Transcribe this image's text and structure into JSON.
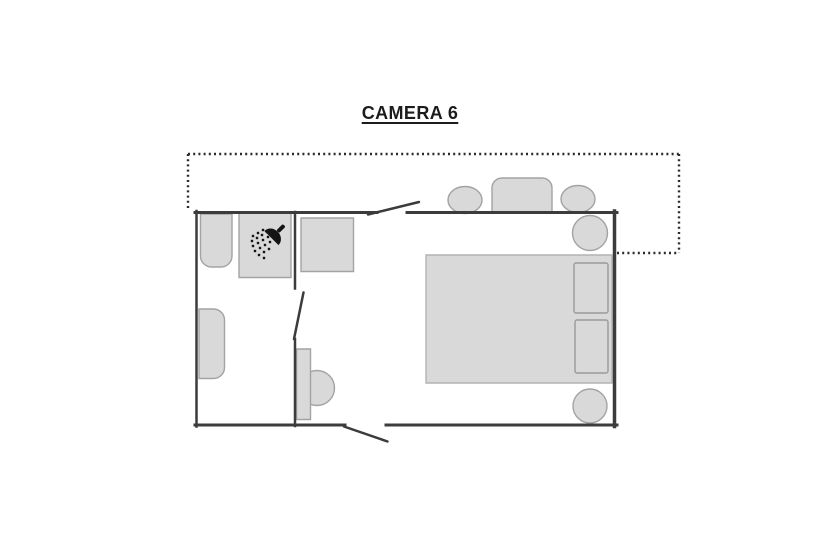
{
  "title": {
    "text": "CAMERA 6"
  },
  "canvas": {
    "width": 820,
    "height": 560
  },
  "colors": {
    "background": "#ffffff",
    "wall": "#3c3c3c",
    "door": "#3c3c3c",
    "dotted": "#2b2b2b",
    "furniture_fill": "#d9d9d9",
    "furniture_stroke": "#a3a3a3",
    "pillow_stroke": "#9a9a9a",
    "bed_stroke": "#b3b3b3",
    "icon": "#141414",
    "title_color": "#1c1c1c"
  },
  "plan": {
    "terrace_outline": {
      "name": "terrace-dotted-outline",
      "dash": "2 3.2",
      "width": 2.4,
      "segments": [
        [
          188,
          154,
          680,
          154
        ],
        [
          188,
          154,
          188,
          209
        ],
        [
          679,
          154,
          679,
          253
        ],
        [
          617,
          253,
          679,
          253
        ]
      ]
    },
    "furniture": [
      {
        "name": "terrace-chair-left",
        "type": "ellipse",
        "cx": 465,
        "cy": 200,
        "rx": 17,
        "ry": 13.5
      },
      {
        "name": "terrace-table",
        "type": "rect",
        "x": 492,
        "y": 178,
        "w": 60,
        "h": 34.5,
        "radii": [
          10,
          10,
          2,
          2
        ]
      },
      {
        "name": "terrace-chair-right",
        "type": "ellipse",
        "cx": 578,
        "cy": 199,
        "rx": 17,
        "ry": 13.5
      },
      {
        "name": "washbasin",
        "type": "rect",
        "x": 200.5,
        "y": 214,
        "w": 31.5,
        "h": 53,
        "radii": [
          0,
          0,
          11,
          11
        ]
      },
      {
        "name": "shower-tray",
        "type": "rect",
        "x": 239,
        "y": 213,
        "w": 52,
        "h": 64.5,
        "radii": [
          0,
          0,
          0,
          0
        ]
      },
      {
        "name": "toilet",
        "type": "rect",
        "x": 199,
        "y": 309,
        "w": 25.5,
        "h": 69.5,
        "radii": [
          0,
          11,
          11,
          0
        ]
      },
      {
        "name": "media-cabinet",
        "type": "rect",
        "x": 301,
        "y": 218,
        "w": 52.5,
        "h": 53.5,
        "radii": [
          0,
          0,
          0,
          0
        ]
      },
      {
        "name": "desk-chair",
        "type": "circle",
        "cx": 317,
        "cy": 388,
        "r": 17.5
      },
      {
        "name": "desk",
        "type": "rect",
        "x": 296.5,
        "y": 349,
        "w": 14,
        "h": 70.5,
        "radii": [
          0,
          0,
          0,
          0
        ]
      },
      {
        "name": "double-bed",
        "type": "rect",
        "x": 426,
        "y": 255,
        "w": 186,
        "h": 128,
        "radii": [
          0,
          0,
          0,
          0
        ],
        "stroke": "#b3b3b3"
      },
      {
        "name": "pillow-top",
        "type": "rect",
        "x": 574,
        "y": 263,
        "w": 34,
        "h": 50,
        "radii": [
          2,
          2,
          2,
          2
        ],
        "stroke": "#9a9a9a"
      },
      {
        "name": "pillow-bottom",
        "type": "rect",
        "x": 575,
        "y": 320,
        "w": 33,
        "h": 53,
        "radii": [
          2,
          2,
          2,
          2
        ],
        "stroke": "#9a9a9a"
      },
      {
        "name": "bedside-table-top",
        "type": "circle",
        "cx": 590,
        "cy": 233,
        "r": 17.5
      },
      {
        "name": "bedside-table-bottom",
        "type": "circle",
        "cx": 590,
        "cy": 406,
        "r": 17
      }
    ],
    "walls": [
      {
        "name": "wall-top-left-segment",
        "x1": 195,
        "y1": 212.5,
        "x2": 377,
        "y2": 212.5,
        "w": 3
      },
      {
        "name": "wall-top-right-segment",
        "x1": 407,
        "y1": 212.5,
        "x2": 617,
        "y2": 212.5,
        "w": 3
      },
      {
        "name": "wall-left",
        "x1": 196.5,
        "y1": 211,
        "x2": 196.5,
        "y2": 426.5,
        "w": 2.5
      },
      {
        "name": "wall-right",
        "x1": 614.5,
        "y1": 211,
        "x2": 614.5,
        "y2": 426.5,
        "w": 3.5
      },
      {
        "name": "wall-bottom-left-segment",
        "x1": 195,
        "y1": 425,
        "x2": 345,
        "y2": 425,
        "w": 3
      },
      {
        "name": "wall-bottom-right-segment",
        "x1": 386,
        "y1": 425,
        "x2": 617,
        "y2": 425,
        "w": 3
      },
      {
        "name": "bathroom-wall-upper",
        "x1": 295,
        "y1": 212,
        "x2": 295,
        "y2": 288.5,
        "w": 2.5
      },
      {
        "name": "bathroom-wall-lower",
        "x1": 295,
        "y1": 339,
        "x2": 295,
        "y2": 426,
        "w": 2.5
      }
    ],
    "doors": [
      {
        "name": "entrance-door-leaf",
        "x1": 368,
        "y1": 214.5,
        "x2": 419,
        "y2": 202,
        "w": 2.5
      },
      {
        "name": "bathroom-door-leaf",
        "x1": 303.5,
        "y1": 292.5,
        "x2": 294,
        "y2": 339,
        "w": 2.5
      },
      {
        "name": "terrace-door-leaf",
        "x1": 344,
        "y1": 426.5,
        "x2": 387.5,
        "y2": 441.5,
        "w": 2.5
      }
    ],
    "shower_icon": {
      "name": "shower-head-icon",
      "head": {
        "cx": 272.5,
        "cy": 237,
        "rx": 10,
        "ry": 9,
        "rotation": 45
      },
      "handle": {
        "x": -2,
        "y": -16.5,
        "w": 4,
        "h": 9,
        "rx": 1.5
      },
      "dot_size": 2.4,
      "dots": [
        [
          253,
          236
        ],
        [
          258,
          233
        ],
        [
          263,
          230
        ],
        [
          252,
          241
        ],
        [
          257,
          238
        ],
        [
          262,
          235
        ],
        [
          267,
          232
        ],
        [
          253,
          246
        ],
        [
          258,
          243
        ],
        [
          263,
          240
        ],
        [
          268,
          237
        ],
        [
          255,
          251
        ],
        [
          260,
          248
        ],
        [
          265,
          245
        ],
        [
          270,
          242
        ],
        [
          259,
          255
        ],
        [
          264,
          252
        ],
        [
          269,
          249
        ],
        [
          264,
          258
        ]
      ]
    }
  }
}
